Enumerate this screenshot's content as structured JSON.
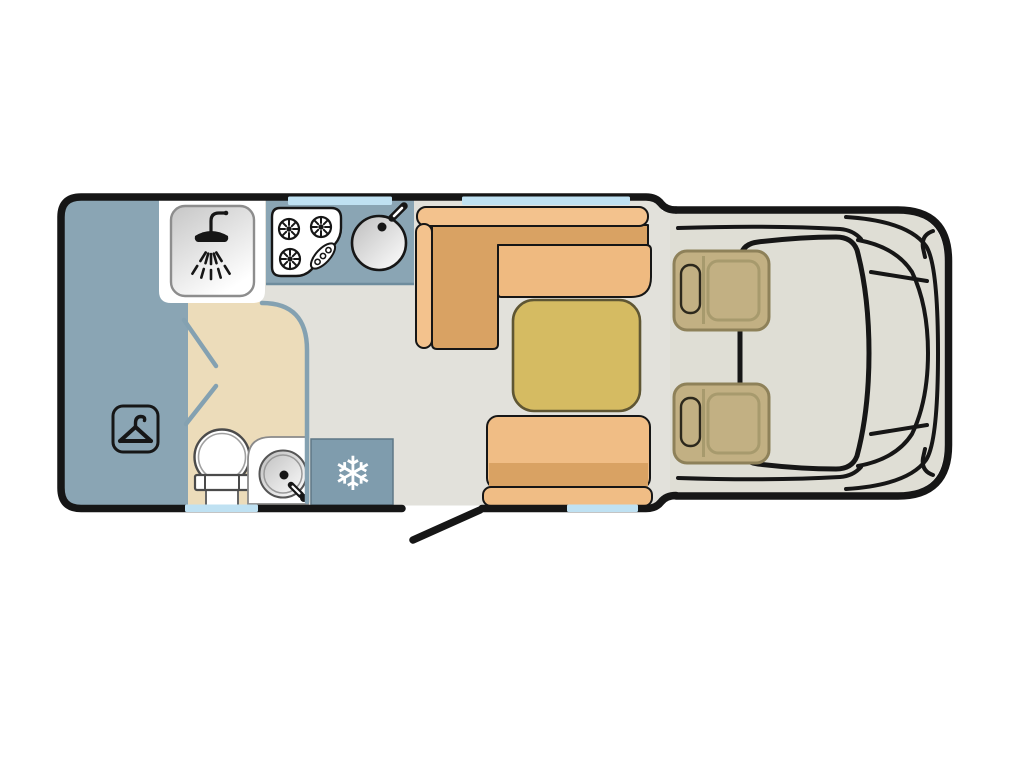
{
  "title": "motorhome-floorplan-top-view",
  "colors": {
    "background": "#ffffff",
    "outline": "#161616",
    "floor": "#e2e1db",
    "cab_floor": "#dfded5",
    "wardrobe_blue": "#8aa5b4",
    "counter_blue": "#8aa5b4",
    "fridge_blue": "#7f9cad",
    "bathroom_beige": "#ecdcba",
    "window_blue": "#bfe1f2",
    "divider_blue": "#84a1b1",
    "white": "#ffffff",
    "sofa_back": "#f3c28d",
    "sofa_base": "#d9a263",
    "sofa_cushion": "#efba80",
    "table_yellow": "#d5bb62",
    "table_outline": "#5f5633",
    "bench": "#f0bd85",
    "bench_shadow": "#d9a263",
    "cab_seat": "#c2b083",
    "cab_seat_outline": "#8e8159",
    "cab_seat_inner": "#a79a6d",
    "icon_dark": "#161616",
    "snowflake_white": "#ffffff"
  },
  "icons": {
    "snowflake": "❄",
    "shower": "svg-shape",
    "coat_hanger": "svg-shape",
    "hob_burners": "svg-shape",
    "kitchen_sink": "svg-shape",
    "toilet": "svg-shape",
    "washbasin": "svg-shape"
  }
}
